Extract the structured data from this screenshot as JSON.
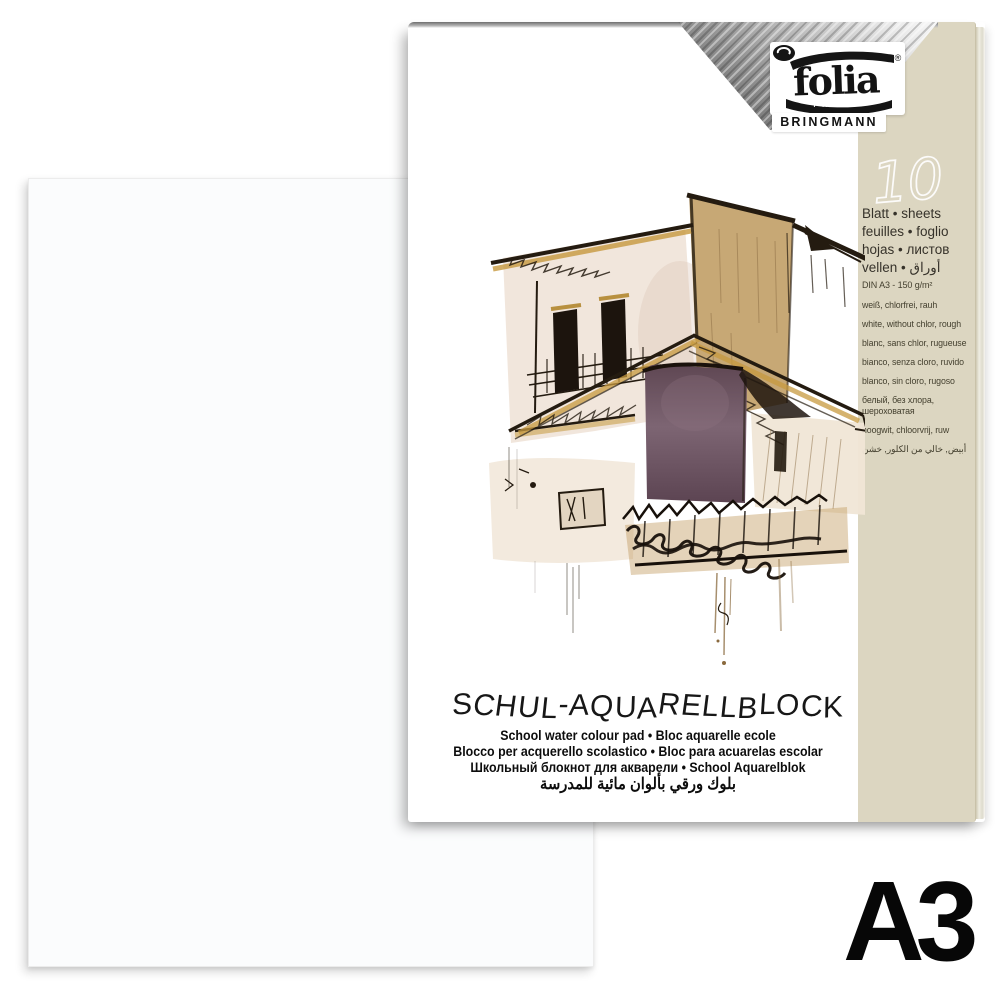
{
  "product": {
    "brand": {
      "name": "folia",
      "sub_label": "PAPER",
      "company": "BRINGMANN",
      "registered_mark": "®"
    },
    "sheet_count": "10",
    "sheet_count_labels": [
      "Blatt • sheets",
      "feuilles • foglio",
      "hojas • листов",
      "vellen • أوراق"
    ],
    "specs": {
      "format_weight": "DIN A3 - 150 g/m²",
      "languages": [
        "weiß, chlorfrei, rauh",
        "white, without chlor, rough",
        "blanc, sans chlor, rugueuse",
        "bianco, senza cloro, ruvido",
        "blanco, sin cloro, rugoso",
        "белый, без хлора,\nшероховатая",
        "hoogwit, chloorvrij, ruw",
        "أبيض, خالي من الكلور, خشن"
      ]
    },
    "title": "SCHUL-AQUARELLBLOCK",
    "subtitles": [
      "School water colour pad • Bloc aquarelle ecole",
      "Blocco per acquerello scolastico • Bloc para acuarelas escolar",
      "Школьный блокнот для акварели • School Aquarelblok",
      "بلوك ورقي بألوان مائية للمدرسة"
    ],
    "format_badge": "A3"
  },
  "illustration": "watercolor-house-sketch",
  "colors": {
    "panel_beige": "#dcd6c1",
    "ink": "#241b10",
    "wash_tan": "#c7a875",
    "wash_plum": "#6e5463",
    "band_dark": "#3f3f3f",
    "background": "#ffffff"
  }
}
